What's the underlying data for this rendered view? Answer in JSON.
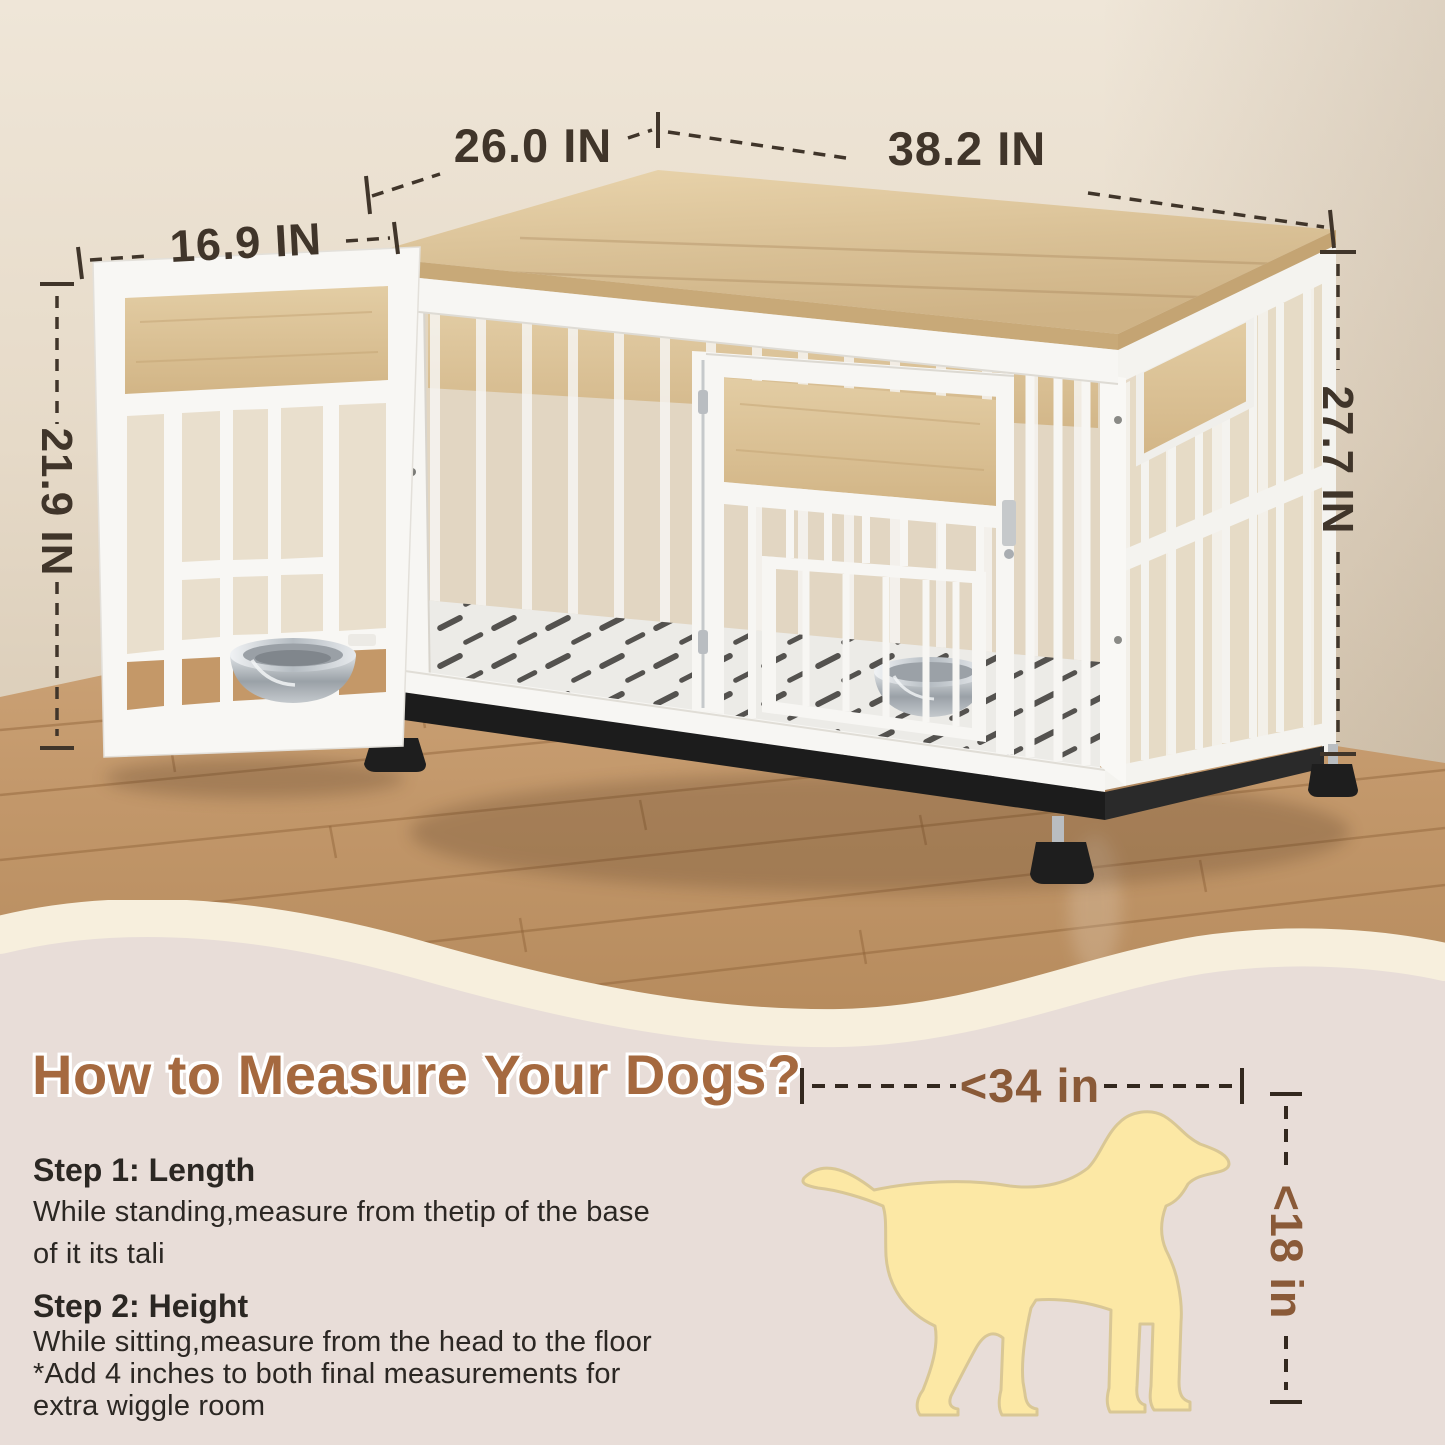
{
  "photo": {
    "labels": {
      "top_depth": "26.0 IN",
      "top_width": "38.2 IN",
      "door_width": "16.9 IN",
      "door_height": "21.9 IN",
      "crate_height": "27.7 IN"
    }
  },
  "guide": {
    "heading": "How to Measure Your Dogs?",
    "step1": {
      "title": "Step 1: Length",
      "line1": "While standing,measure from thetip of the base",
      "line2": "of it its tali"
    },
    "step2": {
      "title": "Step 2: Height",
      "line1": "While sitting,measure from the head to the floor",
      "line2": "*Add 4 inches to both final measurements for",
      "line3": "extra wiggle room"
    },
    "dog": {
      "length": "<34 in",
      "height": "<18 in"
    }
  },
  "colors": {
    "accent_brown": "#a5693f",
    "dimension_dark": "#40352a",
    "guide_dimension_brown": "#8a5a38",
    "dog_fill": "#fce8a5",
    "wave_cream": "#f7efdd",
    "panel_background": "#e8ddd8",
    "crate_white": "#f7f6f3",
    "wood_top": "#d8bf94",
    "floor_wood": "#c2976a"
  }
}
